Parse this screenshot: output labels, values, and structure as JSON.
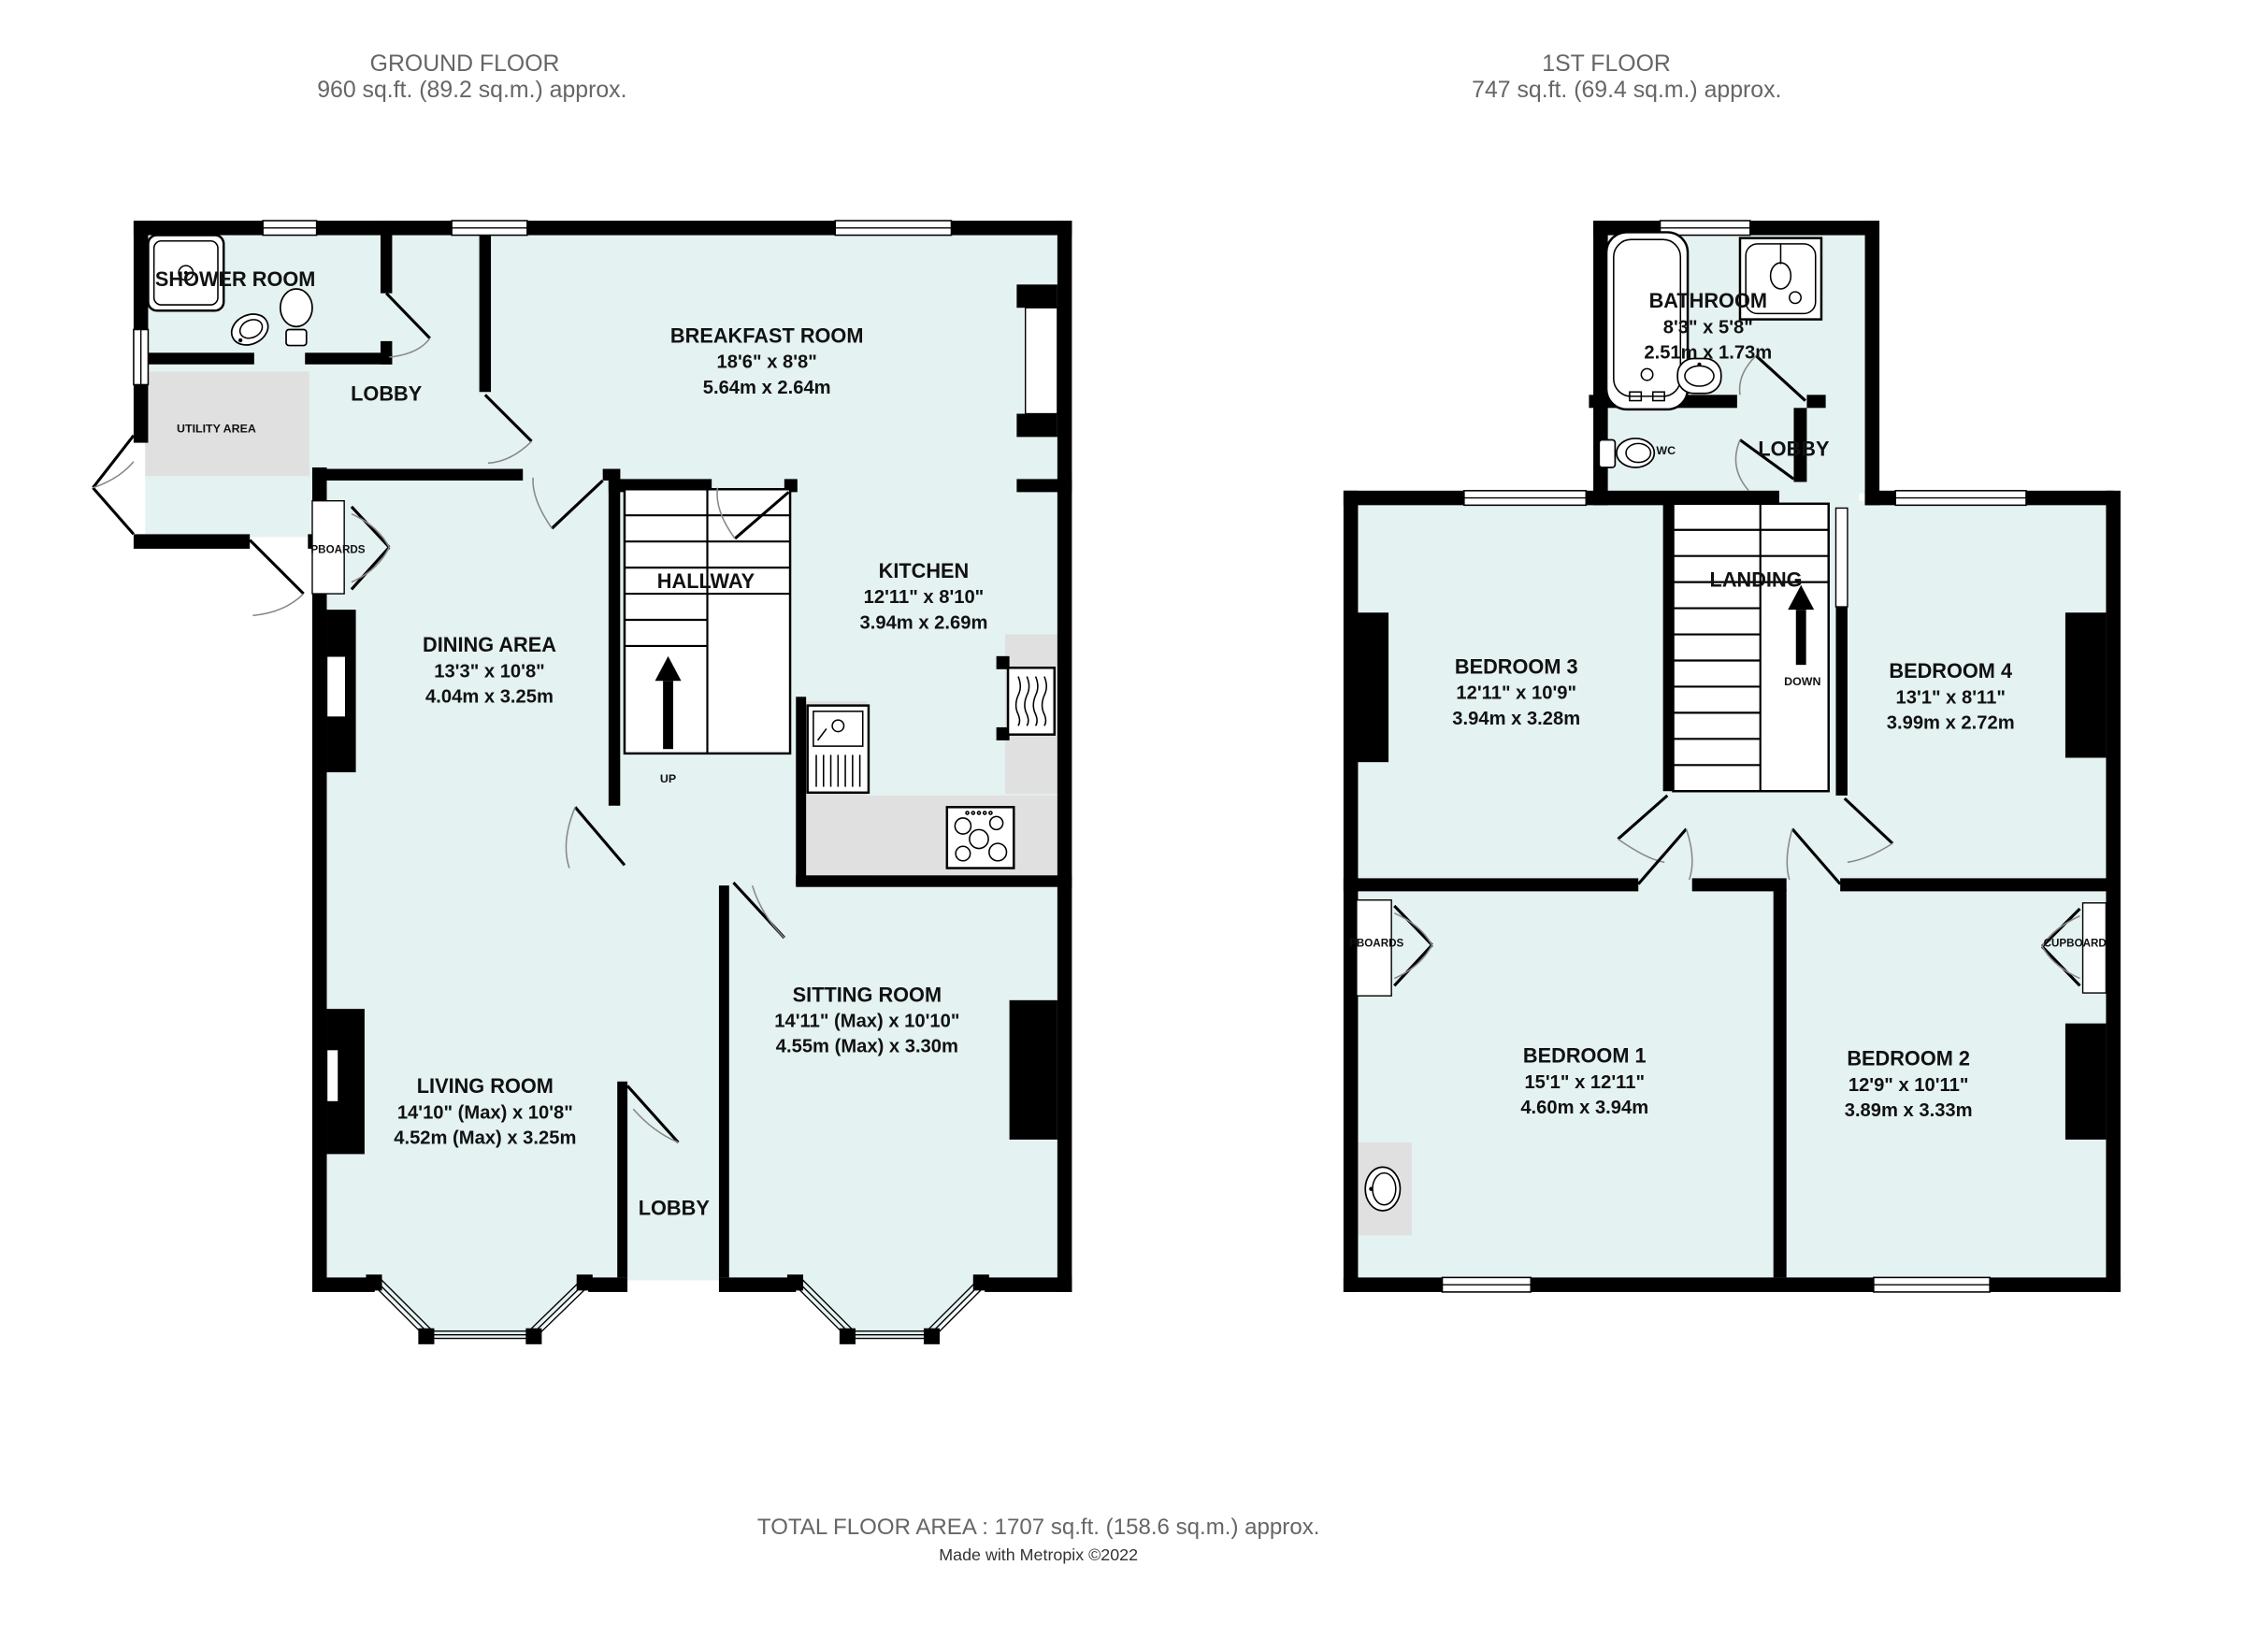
{
  "colors": {
    "room_fill": "#e4f2f1",
    "wall": "#000000",
    "counter_gray": "#e0e0e0",
    "header_text": "#666666",
    "label_text": "#111111"
  },
  "headers": {
    "ground_floor": {
      "title": "GROUND FLOOR",
      "area": "960 sq.ft. (89.2 sq.m.) approx."
    },
    "first_floor": {
      "title": "1ST FLOOR",
      "area": "747 sq.ft. (69.4 sq.m.) approx."
    }
  },
  "ground_floor": {
    "shower_room": {
      "name": "SHOWER ROOM"
    },
    "lobby_top": {
      "name": "LOBBY"
    },
    "utility_area": {
      "name": "UTILITY AREA"
    },
    "cupboards_label": "PBOARDS",
    "breakfast_room": {
      "name": "BREAKFAST ROOM",
      "imperial": "18'6\"  x 8'8\"",
      "metric": "5.64m  x 2.64m"
    },
    "kitchen": {
      "name": "KITCHEN",
      "imperial": "12'11\"  x 8'10\"",
      "metric": "3.94m  x 2.69m"
    },
    "hallway": {
      "name": "HALLWAY"
    },
    "up_label": "UP",
    "dining_area": {
      "name": "DINING AREA",
      "imperial": "13'3\"  x 10'8\"",
      "metric": "4.04m  x 3.25m"
    },
    "living_room": {
      "name": "LIVING ROOM",
      "imperial": "14'10\" (Max) x 10'8\"",
      "metric": "4.52m (Max) x 3.25m"
    },
    "sitting_room": {
      "name": "SITTING ROOM",
      "imperial": "14'11\" (Max) x 10'10\"",
      "metric": "4.55m (Max) x 3.30m"
    },
    "lobby_bottom": {
      "name": "LOBBY"
    }
  },
  "first_floor": {
    "bathroom": {
      "name": "BATHROOM",
      "imperial": "8'3\"  x 5'8\"",
      "metric": "2.51m  x 1.73m"
    },
    "wc_label": "WC",
    "lobby": {
      "name": "LOBBY"
    },
    "landing": {
      "name": "LANDING"
    },
    "down_label": "DOWN",
    "bedroom3": {
      "name": "BEDROOM 3",
      "imperial": "12'11\"  x 10'9\"",
      "metric": "3.94m  x 3.28m"
    },
    "bedroom4": {
      "name": "BEDROOM 4",
      "imperial": "13'1\"  x 8'11\"",
      "metric": "3.99m  x 2.72m"
    },
    "bedroom1": {
      "name": "BEDROOM 1",
      "imperial": "15'1\"  x 12'11\"",
      "metric": "4.60m  x 3.94m"
    },
    "bedroom2": {
      "name": "BEDROOM 2",
      "imperial": "12'9\"  x 10'11\"",
      "metric": "3.89m  x 3.33m"
    },
    "cupboards_left_label": "PBOARDS",
    "cupboard_right_label": "CUPBOARD"
  },
  "footer": {
    "total": "TOTAL FLOOR AREA : 1707 sq.ft. (158.6 sq.m.) approx.",
    "credit": "Made with Metropix ©2022"
  }
}
